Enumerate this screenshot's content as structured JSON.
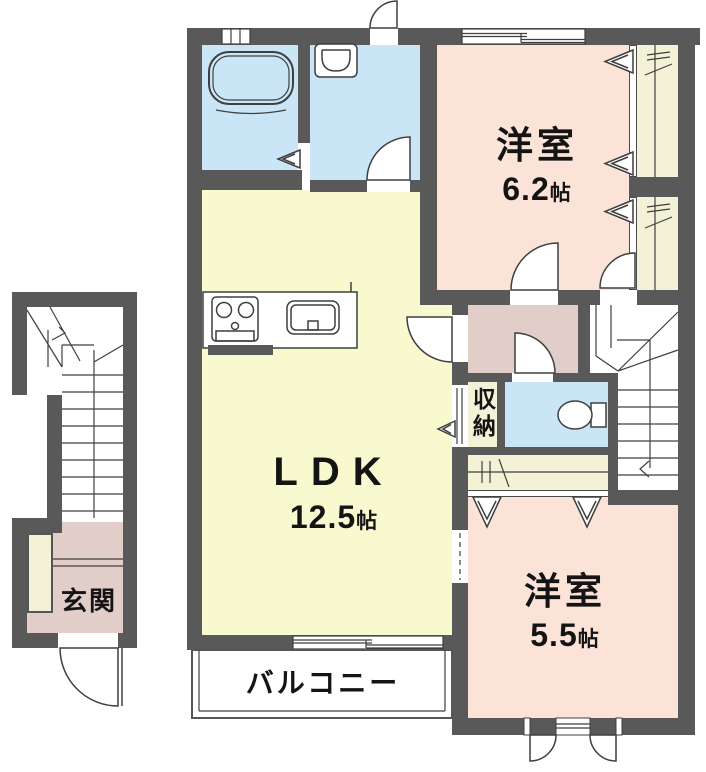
{
  "colors": {
    "wall": "#595959",
    "water_blue": "#c9e5f6",
    "ldk_yellow": "#f9f9d0",
    "bedroom_pink": "#fbe3d8",
    "hall_mauve": "#e1cec8",
    "closet_cream": "#f4f2d6",
    "line": "#3f3f3f"
  },
  "rooms": {
    "bedroom_upper": {
      "name": "洋室",
      "size_value": "6.2",
      "size_unit": "帖"
    },
    "ldk": {
      "name": "LDK",
      "size_value": "12.5",
      "size_unit": "帖"
    },
    "bedroom_lower": {
      "name": "洋室",
      "size_value": "5.5",
      "size_unit": "帖"
    },
    "storage": {
      "name": "収納"
    },
    "entrance": {
      "name": "玄関"
    },
    "balcony": {
      "name": "バルコニー"
    }
  }
}
